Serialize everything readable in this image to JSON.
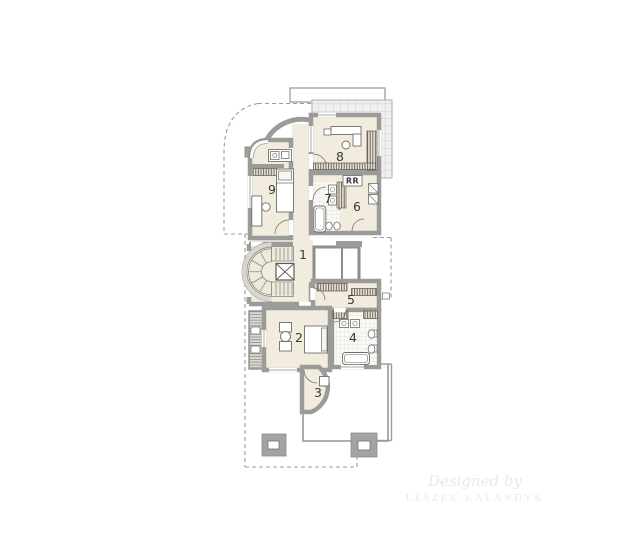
{
  "rooms": {
    "r1": "1",
    "r2": "2",
    "r3": "3",
    "r4": "4",
    "r5": "5",
    "r6": "6",
    "r7": "7",
    "r8": "8",
    "r9": "9"
  },
  "appliance_label": "RR",
  "watermark": {
    "line1": "Designed by",
    "line2": "LESZEK KALANDYK"
  },
  "colors": {
    "floor": "#f2ecdf",
    "wall": "#9b9b99",
    "wall_edge": "#6f6f6d",
    "glass_grid_bg": "#f0f0ee",
    "glass_grid_line": "#c3c3c1",
    "tile_bg": "#fbfaf7",
    "tile_line": "#dedbd2",
    "hatch_line": "#5a564f",
    "balcony_bg": "#dbd9d3",
    "terrace_line": "#a2a2a0",
    "dashed_line": "#9c9c9a",
    "label_text": "#3a3a3a",
    "watermark_text": "#e9e8e5"
  }
}
